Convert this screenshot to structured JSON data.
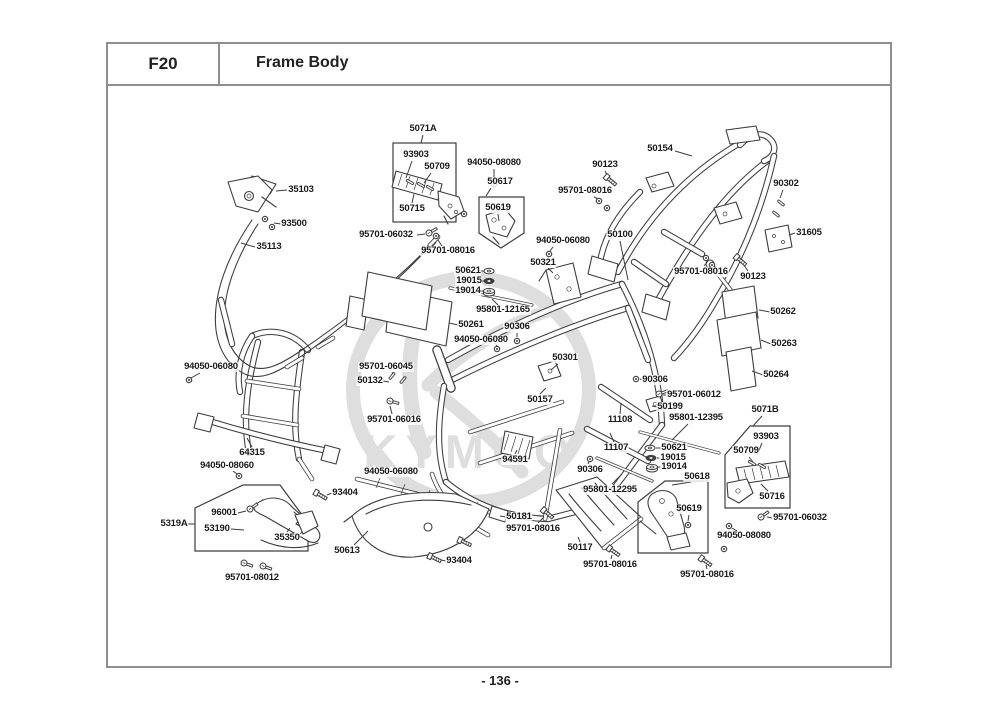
{
  "header": {
    "code": "F20",
    "title": "Frame Body"
  },
  "footer": {
    "page_number": "- 136 -"
  },
  "watermark": {
    "brand": "KYMCO"
  },
  "labels": [
    {
      "text": "5071A",
      "x": 423,
      "y": 129,
      "line": [
        423,
        135,
        421,
        143
      ]
    },
    {
      "text": "93903",
      "x": 416,
      "y": 155,
      "line": [
        412,
        161,
        406,
        178
      ]
    },
    {
      "text": "50709",
      "x": 437,
      "y": 167,
      "line": [
        431,
        173,
        424,
        183
      ]
    },
    {
      "text": "50715",
      "x": 412,
      "y": 209,
      "line": [
        412,
        203,
        414,
        194
      ]
    },
    {
      "text": "94050-08080",
      "x": 494,
      "y": 163,
      "line": [
        494,
        169,
        494,
        181
      ]
    },
    {
      "text": "50617",
      "x": 500,
      "y": 182,
      "line": [
        491,
        188,
        486,
        196
      ]
    },
    {
      "text": "50619",
      "x": 498,
      "y": 208,
      "line": [
        498,
        214,
        499,
        221
      ]
    },
    {
      "text": "95701-06032",
      "x": 386,
      "y": 235,
      "line": [
        417,
        235,
        425,
        234
      ]
    },
    {
      "text": "95701-08016",
      "x": 448,
      "y": 251,
      "line": [
        442,
        246,
        438,
        240
      ]
    },
    {
      "text": "90123",
      "x": 605,
      "y": 165,
      "line": [
        605,
        171,
        608,
        177
      ]
    },
    {
      "text": "95701-08016",
      "x": 585,
      "y": 191,
      "line": [
        594,
        197,
        600,
        200
      ]
    },
    {
      "text": "50154",
      "x": 660,
      "y": 149,
      "line": [
        675,
        151,
        692,
        156
      ]
    },
    {
      "text": "90302",
      "x": 786,
      "y": 184,
      "line": [
        783,
        190,
        780,
        198
      ]
    },
    {
      "text": "31605",
      "x": 809,
      "y": 233,
      "line": [
        795,
        233,
        789,
        235
      ]
    },
    {
      "text": "90123",
      "x": 753,
      "y": 277,
      "line": [
        748,
        271,
        743,
        264
      ]
    },
    {
      "text": "95701-08016",
      "x": 701,
      "y": 272,
      "line": [
        704,
        266,
        708,
        261
      ]
    },
    {
      "text": "35103",
      "x": 301,
      "y": 190,
      "line": [
        287,
        190,
        276,
        191
      ]
    },
    {
      "text": "93500",
      "x": 294,
      "y": 224,
      "line": [
        281,
        224,
        274,
        223
      ]
    },
    {
      "text": "35113",
      "x": 269,
      "y": 247,
      "line": [
        255,
        247,
        241,
        243
      ]
    },
    {
      "text": "94050-06080",
      "x": 563,
      "y": 241,
      "line": [
        553,
        247,
        550,
        251
      ]
    },
    {
      "text": "50321",
      "x": 543,
      "y": 263,
      "line": [
        548,
        268,
        553,
        273
      ]
    },
    {
      "text": "50100",
      "x": 620,
      "y": 235,
      "line": [
        620,
        241,
        628,
        280
      ]
    },
    {
      "text": "50621",
      "x": 468,
      "y": 271,
      "line": [
        480,
        271,
        484,
        271
      ]
    },
    {
      "text": "19015",
      "x": 469,
      "y": 281,
      "line": [
        481,
        281,
        484,
        281
      ]
    },
    {
      "text": "19014",
      "x": 468,
      "y": 291,
      "line": [
        480,
        291,
        484,
        291
      ]
    },
    {
      "text": "95801-12165",
      "x": 503,
      "y": 310,
      "line": [
        498,
        305,
        492,
        299
      ]
    },
    {
      "text": "50261",
      "x": 471,
      "y": 325,
      "line": [
        458,
        325,
        449,
        323
      ]
    },
    {
      "text": "90306",
      "x": 517,
      "y": 327,
      "line": [
        517,
        333,
        517,
        337
      ]
    },
    {
      "text": "94050-06080",
      "x": 481,
      "y": 340,
      "line": [
        495,
        343,
        497,
        346
      ]
    },
    {
      "text": "50301",
      "x": 565,
      "y": 358,
      "line": [
        558,
        364,
        551,
        370
      ]
    },
    {
      "text": "50262",
      "x": 783,
      "y": 312,
      "line": [
        770,
        312,
        759,
        310
      ]
    },
    {
      "text": "50263",
      "x": 784,
      "y": 344,
      "line": [
        771,
        344,
        761,
        340
      ]
    },
    {
      "text": "50264",
      "x": 776,
      "y": 375,
      "line": [
        763,
        375,
        752,
        371
      ]
    },
    {
      "text": "94050-06080",
      "x": 211,
      "y": 367,
      "line": [
        200,
        373,
        191,
        378
      ]
    },
    {
      "text": "95701-06045",
      "x": 386,
      "y": 367,
      "line": [
        392,
        372,
        393,
        374
      ]
    },
    {
      "text": "50132",
      "x": 370,
      "y": 381,
      "line": [
        383,
        381,
        389,
        382
      ]
    },
    {
      "text": "95701-06016",
      "x": 394,
      "y": 420,
      "line": [
        392,
        414,
        390,
        406
      ]
    },
    {
      "text": "50157",
      "x": 540,
      "y": 400,
      "line": [
        540,
        394,
        546,
        388
      ]
    },
    {
      "text": "90306",
      "x": 655,
      "y": 380,
      "line": [
        644,
        380,
        640,
        379
      ]
    },
    {
      "text": "95701-06012",
      "x": 694,
      "y": 395,
      "line": [
        666,
        395,
        663,
        395
      ]
    },
    {
      "text": "50199",
      "x": 670,
      "y": 407,
      "line": [
        657,
        407,
        652,
        406
      ]
    },
    {
      "text": "95801-12395",
      "x": 696,
      "y": 418,
      "line": [
        688,
        424,
        672,
        440
      ]
    },
    {
      "text": "11108",
      "x": 620,
      "y": 420,
      "line": [
        620,
        414,
        621,
        403
      ]
    },
    {
      "text": "11107",
      "x": 616,
      "y": 448,
      "line": [
        614,
        442,
        610,
        433
      ]
    },
    {
      "text": "50621",
      "x": 674,
      "y": 448,
      "line": [
        661,
        448,
        656,
        448
      ]
    },
    {
      "text": "19015",
      "x": 673,
      "y": 458,
      "line": [
        660,
        458,
        657,
        458
      ]
    },
    {
      "text": "19014",
      "x": 674,
      "y": 467,
      "line": [
        661,
        467,
        658,
        467
      ]
    },
    {
      "text": "5071B",
      "x": 765,
      "y": 410,
      "line": [
        762,
        416,
        753,
        426
      ]
    },
    {
      "text": "93903",
      "x": 766,
      "y": 437,
      "line": [
        762,
        443,
        757,
        455
      ]
    },
    {
      "text": "50709",
      "x": 746,
      "y": 451,
      "line": [
        749,
        457,
        753,
        462
      ]
    },
    {
      "text": "50716",
      "x": 772,
      "y": 497,
      "line": [
        768,
        491,
        761,
        484
      ]
    },
    {
      "text": "95701-06032",
      "x": 800,
      "y": 518,
      "line": [
        772,
        518,
        767,
        517
      ]
    },
    {
      "text": "94050-08080",
      "x": 744,
      "y": 536,
      "line": [
        737,
        531,
        732,
        528
      ]
    },
    {
      "text": "95701-08016",
      "x": 707,
      "y": 575,
      "line": [
        707,
        569,
        706,
        565
      ]
    },
    {
      "text": "50618",
      "x": 697,
      "y": 477,
      "line": [
        691,
        482,
        672,
        485
      ]
    },
    {
      "text": "50619",
      "x": 689,
      "y": 509,
      "line": [
        689,
        515,
        688,
        521
      ]
    },
    {
      "text": "5319A",
      "x": 174,
      "y": 524,
      "line": [
        188,
        524,
        195,
        524
      ]
    },
    {
      "text": "96001",
      "x": 224,
      "y": 513,
      "line": [
        238,
        513,
        246,
        511
      ]
    },
    {
      "text": "53190",
      "x": 217,
      "y": 529,
      "line": [
        231,
        529,
        244,
        530
      ]
    },
    {
      "text": "35350",
      "x": 287,
      "y": 538,
      "line": [
        287,
        532,
        290,
        528
      ]
    },
    {
      "text": "95701-08012",
      "x": 252,
      "y": 578,
      "line": null
    },
    {
      "text": "64315",
      "x": 252,
      "y": 453,
      "line": [
        252,
        447,
        247,
        438
      ]
    },
    {
      "text": "94050-08060",
      "x": 227,
      "y": 466,
      "line": [
        233,
        471,
        237,
        474
      ]
    },
    {
      "text": "93404",
      "x": 345,
      "y": 493,
      "line": [
        332,
        493,
        327,
        495
      ]
    },
    {
      "text": "94050-06080",
      "x": 391,
      "y": 472,
      "line": [
        405,
        472,
        412,
        472
      ]
    },
    {
      "text": "50613",
      "x": 347,
      "y": 551,
      "line": [
        354,
        545,
        368,
        531
      ]
    },
    {
      "text": "93404",
      "x": 459,
      "y": 561,
      "line": [
        446,
        561,
        441,
        560
      ]
    },
    {
      "text": "94591",
      "x": 515,
      "y": 460,
      "line": [
        515,
        454,
        517,
        450
      ]
    },
    {
      "text": "90306",
      "x": 590,
      "y": 470,
      "line": [
        588,
        464,
        589,
        462
      ]
    },
    {
      "text": "95801-12295",
      "x": 610,
      "y": 490,
      "line": [
        612,
        484,
        622,
        474
      ]
    },
    {
      "text": "50181",
      "x": 519,
      "y": 517,
      "line": [
        506,
        517,
        500,
        516
      ]
    },
    {
      "text": "95701-08016",
      "x": 533,
      "y": 529,
      "line": [
        538,
        523,
        544,
        517
      ]
    },
    {
      "text": "50117",
      "x": 580,
      "y": 548,
      "line": [
        580,
        542,
        578,
        537
      ]
    },
    {
      "text": "95701-08016",
      "x": 610,
      "y": 565,
      "line": [
        611,
        559,
        612,
        555
      ]
    }
  ],
  "markers": [
    {
      "type": "washer",
      "x": 489,
      "y": 271
    },
    {
      "type": "damper",
      "x": 489,
      "y": 281
    },
    {
      "type": "grommet",
      "x": 489,
      "y": 292
    },
    {
      "type": "washer",
      "x": 650,
      "y": 448
    },
    {
      "type": "damper",
      "x": 651,
      "y": 458
    },
    {
      "type": "grommet",
      "x": 652,
      "y": 468
    },
    {
      "type": "bolt",
      "x": 610,
      "y": 180,
      "rot": 40
    },
    {
      "type": "bolt",
      "x": 740,
      "y": 260,
      "rot": 40
    },
    {
      "type": "nut",
      "x": 599,
      "y": 201
    },
    {
      "type": "nut",
      "x": 607,
      "y": 208
    },
    {
      "type": "nut",
      "x": 436,
      "y": 236
    },
    {
      "type": "nut",
      "x": 464,
      "y": 214
    },
    {
      "type": "nut",
      "x": 706,
      "y": 258
    },
    {
      "type": "nut",
      "x": 712,
      "y": 265
    },
    {
      "type": "pin",
      "x": 781,
      "y": 203,
      "rot": -50
    },
    {
      "type": "pin",
      "x": 776,
      "y": 214,
      "rot": -50
    },
    {
      "type": "nut",
      "x": 265,
      "y": 219
    },
    {
      "type": "nut",
      "x": 272,
      "y": 227
    },
    {
      "type": "screw",
      "x": 429,
      "y": 233,
      "rot": -30
    },
    {
      "type": "screw",
      "x": 761,
      "y": 517,
      "rot": -35
    },
    {
      "type": "nut",
      "x": 494,
      "y": 184
    },
    {
      "type": "nut",
      "x": 549,
      "y": 254
    },
    {
      "type": "nut",
      "x": 517,
      "y": 341
    },
    {
      "type": "nut",
      "x": 636,
      "y": 379
    },
    {
      "type": "nut",
      "x": 590,
      "y": 459
    },
    {
      "type": "screw",
      "x": 659,
      "y": 394,
      "rot": -20
    },
    {
      "type": "nut",
      "x": 189,
      "y": 380
    },
    {
      "type": "nut",
      "x": 239,
      "y": 476
    },
    {
      "type": "pin",
      "x": 392,
      "y": 376,
      "rot": 40
    },
    {
      "type": "pin",
      "x": 403,
      "y": 380,
      "rot": 40
    },
    {
      "type": "screw",
      "x": 390,
      "y": 401,
      "rot": 15
    },
    {
      "type": "bolt",
      "x": 320,
      "y": 495,
      "rot": 30
    },
    {
      "type": "bolt",
      "x": 434,
      "y": 558,
      "rot": 25
    },
    {
      "type": "bolt",
      "x": 464,
      "y": 542,
      "rot": 25
    },
    {
      "type": "bolt",
      "x": 547,
      "y": 513,
      "rot": 40
    },
    {
      "type": "bolt",
      "x": 613,
      "y": 551,
      "rot": 35
    },
    {
      "type": "bolt",
      "x": 705,
      "y": 561,
      "rot": 35
    },
    {
      "type": "nut",
      "x": 729,
      "y": 526
    },
    {
      "type": "nut",
      "x": 724,
      "y": 549
    },
    {
      "type": "screw",
      "x": 244,
      "y": 563,
      "rot": 20
    },
    {
      "type": "screw",
      "x": 263,
      "y": 566,
      "rot": 20
    },
    {
      "type": "screw",
      "x": 250,
      "y": 509,
      "rot": -35
    },
    {
      "type": "nut",
      "x": 688,
      "y": 525
    },
    {
      "type": "pin",
      "x": 410,
      "y": 182,
      "rot": -60
    },
    {
      "type": "pin",
      "x": 421,
      "y": 185,
      "rot": -60
    },
    {
      "type": "pin",
      "x": 430,
      "y": 188,
      "rot": -60
    },
    {
      "type": "pin",
      "x": 752,
      "y": 463,
      "rot": -60
    },
    {
      "type": "pin",
      "x": 762,
      "y": 466,
      "rot": -60
    },
    {
      "type": "nut",
      "x": 497,
      "y": 349
    }
  ]
}
